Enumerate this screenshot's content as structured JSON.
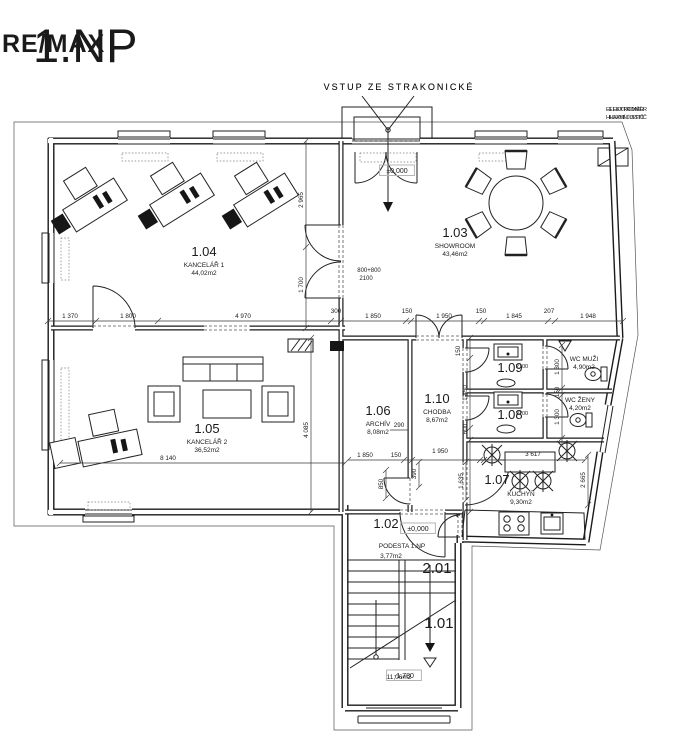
{
  "page": {
    "title": "1.NP",
    "watermark": "RE/MAX"
  },
  "colors": {
    "wall": "#1a1a1a",
    "note": "#b4b4b4",
    "dim": "#2e2e2e",
    "watermark": "#8c8c8c"
  },
  "annotations": {
    "entrance_note": "VSTUP ZE STRAKONICKÉ",
    "meter_line1": "ELEKTROMĚR",
    "meter_line2": "HLAVNÍ JISTIČ"
  },
  "rooms": [
    {
      "num": "1.04",
      "name": "KANCELÁŘ 1",
      "area": "44,02m2",
      "x": 204,
      "y": 256
    },
    {
      "num": "1.03",
      "name": "SHOWROOM",
      "area": "43,46m2",
      "x": 455,
      "y": 237
    },
    {
      "num": "1.05",
      "name": "KANCELÁŘ 2",
      "area": "36,52m2",
      "x": 207,
      "y": 433
    },
    {
      "num": "1.06",
      "name": "ARCHÍV",
      "area": "8,08m2",
      "x": 378,
      "y": 415
    },
    {
      "num": "1.10",
      "name": "CHODBA",
      "area": "8,67m2",
      "x": 437,
      "y": 403
    },
    {
      "num": "1.09",
      "name": "",
      "area": "",
      "x": 510,
      "y": 372
    },
    {
      "num": "1.08",
      "name": "",
      "area": "",
      "x": 510,
      "y": 419
    },
    {
      "num": "1.07",
      "name": "KUCHYŇ",
      "area": "9,30m2",
      "x": 497,
      "y": 484,
      "nx": 521,
      "ny": 496,
      "ax": 521,
      "ay": 504
    },
    {
      "num": "1.02",
      "name": "PODESTA 1.NP",
      "area": "3,77m2",
      "x": 386,
      "y": 528,
      "nx": 402,
      "ny": 548,
      "ax": 391,
      "ay": 558
    },
    {
      "num": "",
      "name": "WC MUŽI",
      "area": "4,90m2",
      "x": 584,
      "y": 361
    },
    {
      "num": "",
      "name": "WC ŽENY",
      "area": "4,20m2",
      "x": 580,
      "y": 402
    },
    {
      "num": "2.01",
      "name": "",
      "area": "",
      "x": 437,
      "y": 573,
      "size": 15
    },
    {
      "num": "1.01",
      "name": "",
      "area": "",
      "x": 439,
      "y": 628,
      "size": 15
    },
    {
      "num": "",
      "name": "",
      "area": "11,06m2",
      "x": 399,
      "y": 671
    }
  ],
  "dims": [
    {
      "t": "1 370",
      "x": 70,
      "y": 318
    },
    {
      "t": "1 800",
      "x": 128,
      "y": 318
    },
    {
      "t": "4 970",
      "x": 243,
      "y": 318
    },
    {
      "t": "300",
      "x": 336,
      "y": 313
    },
    {
      "t": "1 850",
      "x": 373,
      "y": 318
    },
    {
      "t": "150",
      "x": 407,
      "y": 313
    },
    {
      "t": "1 950",
      "x": 444,
      "y": 318
    },
    {
      "t": "150",
      "x": 481,
      "y": 313
    },
    {
      "t": "1 845",
      "x": 514,
      "y": 318
    },
    {
      "t": "207",
      "x": 549,
      "y": 313
    },
    {
      "t": "1 948",
      "x": 588,
      "y": 318
    },
    {
      "t": "1 850",
      "x": 365,
      "y": 457
    },
    {
      "t": "150",
      "x": 396,
      "y": 457
    },
    {
      "t": "1 950",
      "x": 440,
      "y": 453
    },
    {
      "t": "3 617",
      "x": 533,
      "y": 456
    },
    {
      "t": "8 140",
      "x": 168,
      "y": 460
    },
    {
      "t": "290",
      "x": 399,
      "y": 427
    },
    {
      "t": "2 965",
      "x": 303,
      "y": 200,
      "r": -90
    },
    {
      "t": "1 700",
      "x": 303,
      "y": 285,
      "r": -90
    },
    {
      "t": "4 085",
      "x": 308,
      "y": 430,
      "r": -90
    },
    {
      "t": "1 635",
      "x": 463,
      "y": 481,
      "r": -90
    },
    {
      "t": "390",
      "x": 416,
      "y": 474,
      "r": -90
    },
    {
      "t": "850",
      "x": 383,
      "y": 484,
      "r": -90
    },
    {
      "t": "2 665",
      "x": 585,
      "y": 480,
      "r": -90
    },
    {
      "t": "1 450",
      "x": 467,
      "y": 393,
      "r": -90
    },
    {
      "t": "600",
      "x": 467,
      "y": 429,
      "r": -90
    },
    {
      "t": "150",
      "x": 460,
      "y": 351,
      "r": -90
    },
    {
      "t": "1 300",
      "x": 559,
      "y": 367,
      "r": -90
    },
    {
      "t": "150",
      "x": 559,
      "y": 392,
      "r": -90
    },
    {
      "t": "1 300",
      "x": 559,
      "y": 417,
      "r": -90
    }
  ],
  "notes": [
    {
      "t": "VSTUP ZE STRAKONICKÉ",
      "x": 399,
      "y": 90,
      "s": 9,
      "ls": 2
    },
    {
      "t": "ELEKTROMĚR",
      "x": 628,
      "y": 111,
      "s": 5.5
    },
    {
      "t": "HLAVNÍ JISTIČ",
      "x": 628,
      "y": 119,
      "s": 5.5
    },
    {
      "t": "800+800",
      "x": 369,
      "y": 272,
      "s": 6
    },
    {
      "t": "2100",
      "x": 366,
      "y": 280,
      "s": 6
    },
    {
      "t": "2100",
      "x": 522,
      "y": 368,
      "s": 5.5
    },
    {
      "t": "2100",
      "x": 522,
      "y": 415,
      "s": 5.5
    },
    {
      "t": "±0,000",
      "x": 397,
      "y": 173,
      "box": true
    },
    {
      "t": "±0,000",
      "x": 418,
      "y": 531,
      "box": true
    },
    {
      "t": "-1,780",
      "x": 404,
      "y": 678,
      "box": true
    }
  ]
}
